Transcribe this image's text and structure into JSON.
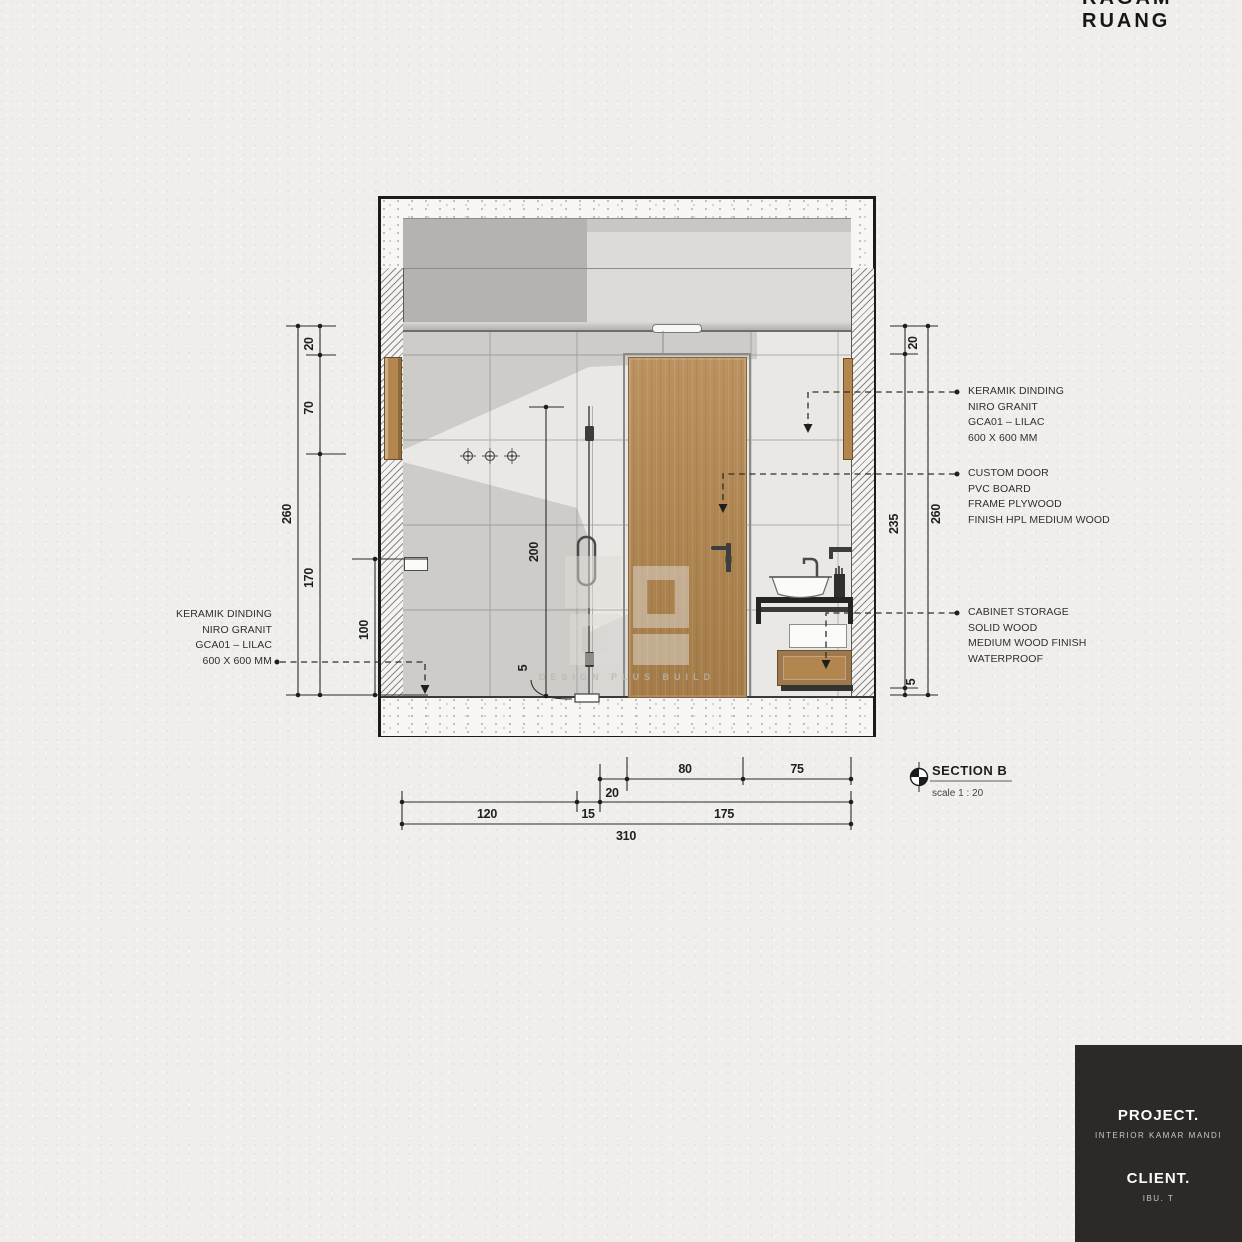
{
  "page": {
    "top_title": "RAGAM RUANG"
  },
  "drawing": {
    "section_title": "SECTION B",
    "section_scale": "scale 1 : 20",
    "watermark_text": "DESIGN PLUS BUILD",
    "annotations": {
      "left_keramik": {
        "lines": [
          "KERAMIK DINDING",
          "NIRO GRANIT",
          "GCA01 – LILAC",
          "600 X 600 MM"
        ]
      },
      "right_keramik": {
        "lines": [
          "KERAMIK DINDING",
          "NIRO GRANIT",
          "GCA01 – LILAC",
          "600 X 600 MM"
        ]
      },
      "custom_door": {
        "lines": [
          "CUSTOM DOOR",
          "PVC BOARD",
          "FRAME PLYWOOD",
          "FINISH HPL MEDIUM WOOD"
        ]
      },
      "cabinet": {
        "lines": [
          "CABINET STORAGE",
          "SOLID WOOD",
          "MEDIUM WOOD FINISH",
          "WATERPROOF"
        ]
      }
    },
    "dimensions": {
      "left": {
        "d260": "260",
        "d20": "20",
        "d70": "70",
        "d170": "170",
        "d100": "100"
      },
      "right": {
        "d260": "260",
        "d20": "20",
        "d235": "235",
        "d5": "5"
      },
      "interior": {
        "d200": "200",
        "d5": "5"
      },
      "bottom": {
        "d20": "20",
        "d80": "80",
        "d75": "75",
        "d120": "120",
        "d15": "15",
        "d175": "175",
        "d310": "310"
      }
    }
  },
  "titleblock": {
    "project_label": "PROJECT.",
    "project_value": "INTERIOR KAMAR MANDI",
    "client_label": "CLIENT.",
    "client_value": "IBU. T"
  },
  "colors": {
    "wood": "#b3854f",
    "titleblock_bg": "#2b2a28",
    "paper": "#efeeec"
  }
}
